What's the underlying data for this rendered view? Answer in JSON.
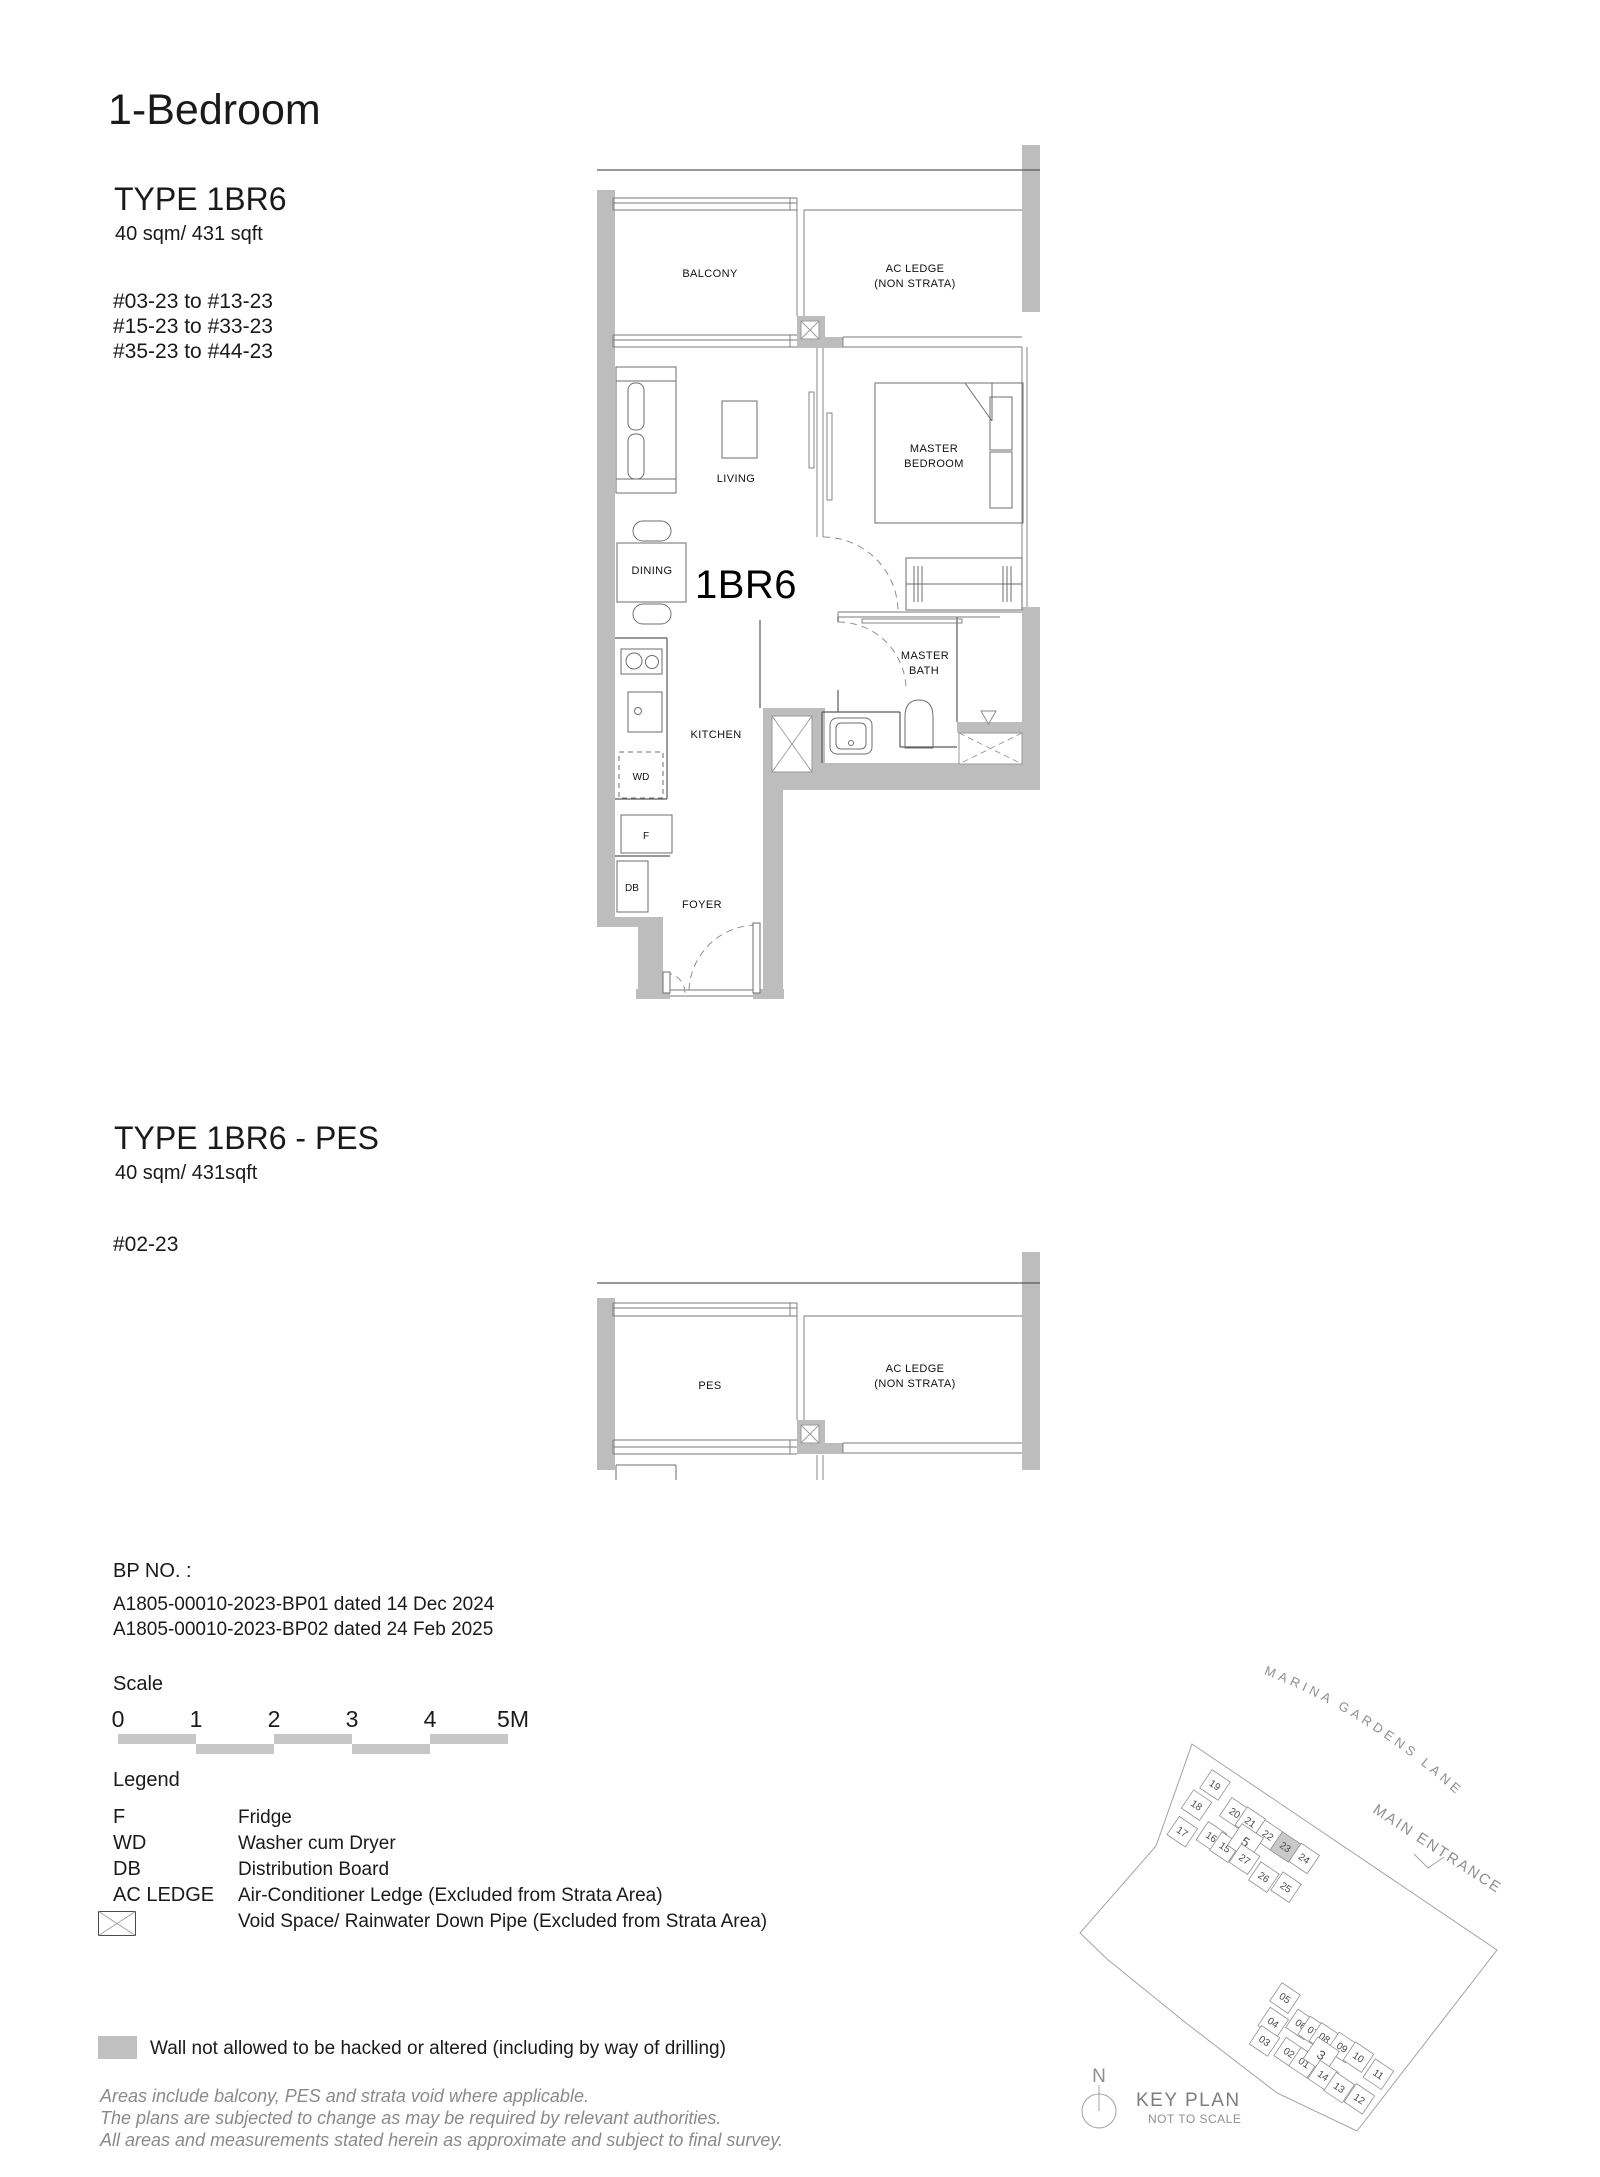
{
  "colors": {
    "wall_gray": "#bdbdbd",
    "plan_line": "#5a5a5a",
    "muted_text": "#8a8a8a",
    "keyplan_gray": "#8f8f8f",
    "highlight_unit_fill": "#c9c9c9",
    "scalebar_gray": "#c7c7c7"
  },
  "icons": {
    "void_space": "crossed-box-icon",
    "rainwater_down_pipe": "triangle-down-icon",
    "north": "compass-icon"
  },
  "page_title": "1-Bedroom",
  "plan_a": {
    "type_label": "TYPE 1BR6",
    "area_label": "40 sqm/ 431 sqft",
    "unit_ranges": [
      "#03-23 to #13-23",
      "#15-23 to #33-23",
      "#35-23 to #44-23"
    ],
    "rooms": {
      "balcony": "BALCONY",
      "ac_ledge_line1": "AC LEDGE",
      "ac_ledge_line2": "(NON STRATA)",
      "living": "LIVING",
      "master_line1": "MASTER",
      "master_line2": "BEDROOM",
      "dining": "DINING",
      "unit_tag": "1BR6",
      "bath_line1": "MASTER",
      "bath_line2": "BATH",
      "kitchen": "KITCHEN",
      "wd": "WD",
      "fridge": "F",
      "db": "DB",
      "foyer": "FOYER"
    }
  },
  "plan_b": {
    "type_label": "TYPE 1BR6 - PES",
    "area_label": "40 sqm/ 431sqft",
    "unit_ranges": [
      "#02-23"
    ],
    "rooms": {
      "pes": "PES",
      "ac_ledge_line1": "AC LEDGE",
      "ac_ledge_line2": "(NON STRATA)"
    }
  },
  "bp": {
    "heading": "BP NO. :",
    "lines": [
      "A1805-00010-2023-BP01 dated 14 Dec 2024",
      "A1805-00010-2023-BP02 dated 24 Feb 2025"
    ]
  },
  "scale": {
    "label": "Scale",
    "ticks": [
      "0",
      "1",
      "2",
      "3",
      "4",
      "5M"
    ]
  },
  "legend": {
    "label": "Legend",
    "rows": [
      {
        "key": "F",
        "desc": "Fridge"
      },
      {
        "key": "WD",
        "desc": "Washer cum Dryer"
      },
      {
        "key": "DB",
        "desc": "Distribution Board"
      },
      {
        "key": "AC LEDGE",
        "desc": "Air-Conditioner Ledge (Excluded from Strata Area)"
      },
      {
        "key": "",
        "desc": "Void Space/ Rainwater Down Pipe (Excluded from Strata Area)"
      }
    ],
    "wall_note": "Wall not allowed to be hacked or altered (including by way of drilling)"
  },
  "footnotes": [
    "Areas include balcony, PES and strata void where applicable.",
    "The plans are subjected to change as may be required by relevant authorities.",
    "All areas and measurements stated herein as approximate and subject to final survey."
  ],
  "key_plan": {
    "street": "MARINA GARDENS LANE",
    "entrance": "MAIN ENTRANCE",
    "title": "KEY PLAN",
    "subtitle": "NOT TO SCALE",
    "north": "N",
    "highlighted_unit": "23",
    "upper_units": [
      "19",
      "18",
      "17",
      "20",
      "21",
      "22",
      "23",
      "24",
      "16",
      "15",
      "5",
      "27",
      "26",
      "25"
    ],
    "lower_units": [
      "05",
      "04",
      "03",
      "06",
      "07",
      "08",
      "09",
      "10",
      "11",
      "02",
      "01",
      "3",
      "14",
      "13",
      "12"
    ]
  }
}
